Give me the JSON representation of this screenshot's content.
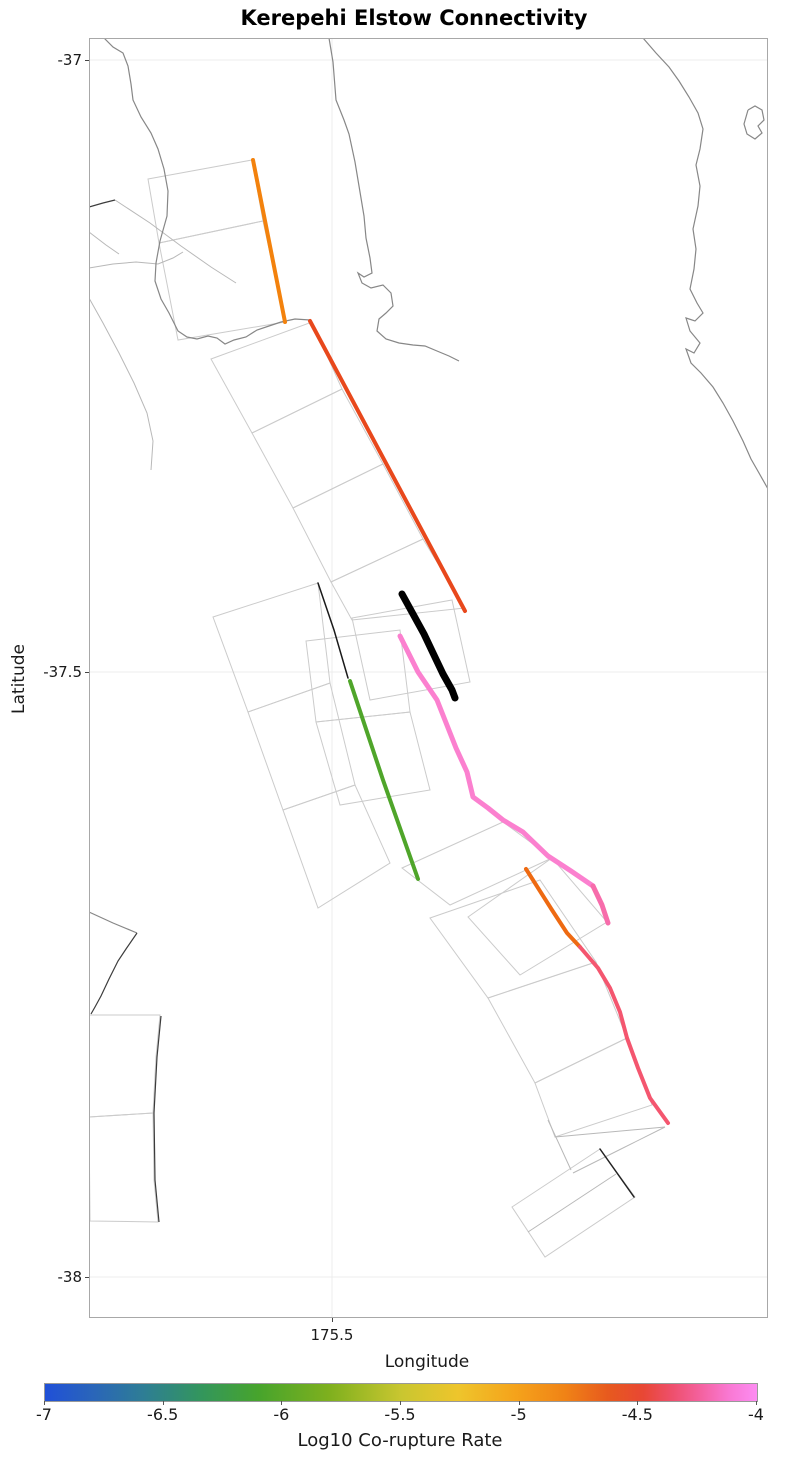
{
  "title": "Kerepehi Elstow Connectivity",
  "axes": {
    "x_label": "Longitude",
    "y_label": "Latitude",
    "x_ticks": [
      "175.5"
    ],
    "y_ticks": [
      "-37",
      "-37.5",
      "-38"
    ]
  },
  "colorbar": {
    "label": "Log10 Co-rupture Rate",
    "ticks": [
      "-7",
      "-6.5",
      "-6",
      "-5.5",
      "-5",
      "-4.5",
      "-4"
    ],
    "min": -7,
    "max": -4,
    "gradient": [
      [
        0,
        "#2050d8"
      ],
      [
        7,
        "#2a66b8"
      ],
      [
        14,
        "#2e7e94"
      ],
      [
        22,
        "#33965c"
      ],
      [
        30,
        "#47a42c"
      ],
      [
        40,
        "#7fb01e"
      ],
      [
        50,
        "#c9c630"
      ],
      [
        58,
        "#eec52c"
      ],
      [
        66,
        "#f5a31b"
      ],
      [
        73,
        "#f08316"
      ],
      [
        79,
        "#e75a1e"
      ],
      [
        84,
        "#e84734"
      ],
      [
        88,
        "#ee4f6b"
      ],
      [
        92,
        "#f4619e"
      ],
      [
        96,
        "#f978d2"
      ],
      [
        100,
        "#fc8cf2"
      ]
    ]
  },
  "chart_data": {
    "type": "map",
    "title": "Kerepehi Elstow Connectivity",
    "xlabel": "Longitude",
    "ylabel": "Latitude",
    "x_ticks": [
      175.5
    ],
    "y_ticks": [
      -37,
      -37.5,
      -38
    ],
    "xlim_approx": [
      175.25,
      175.95
    ],
    "ylim_approx": [
      -38.03,
      -36.98
    ],
    "grid": true,
    "legend_position": "bottom",
    "colorbar": {
      "label": "Log10 Co-rupture Rate",
      "range": [
        -7,
        -4
      ],
      "ticks": [
        -7,
        -6.5,
        -6,
        -5.5,
        -5,
        -4.5,
        -4
      ],
      "orientation": "horizontal"
    },
    "fault_traces": [
      {
        "id": "north-orange",
        "color": "#f3820d",
        "approx_log10_corupture_rate": -4.9
      },
      {
        "id": "central-red-orange",
        "color": "#e8481c",
        "approx_log10_corupture_rate": -4.6
      },
      {
        "id": "thick-black-target",
        "color": "#000000",
        "approx_log10_corupture_rate": null,
        "note": "target section, not on colorbar"
      },
      {
        "id": "thin-black",
        "color": "#1a1a1a",
        "approx_log10_corupture_rate": null
      },
      {
        "id": "central-green",
        "color": "#4fa52a",
        "approx_log10_corupture_rate": -6.0
      },
      {
        "id": "pink",
        "color": "#fb80cf",
        "approx_log10_corupture_rate": -4.2
      },
      {
        "id": "pink-tail",
        "color": "#f76cab",
        "approx_log10_corupture_rate": -4.3
      },
      {
        "id": "south-orange",
        "color": "#ee6a12",
        "approx_log10_corupture_rate": -4.8
      },
      {
        "id": "south-pink-red",
        "color": "#f4566f",
        "approx_log10_corupture_rate": -4.4
      },
      {
        "id": "bottom-black",
        "color": "#222222",
        "approx_log10_corupture_rate": null
      }
    ],
    "features": [
      "firth-of-thames-coastline",
      "coromandel-coastline",
      "offshore-island",
      "fault-surface-projection-patches"
    ]
  },
  "map": {
    "style": {
      "grid": "#ececec",
      "patch": "#cbcbcb",
      "faint": "#b8b8b8",
      "coast": "#878787",
      "dark": "#3c3c3c",
      "border": "#a8a8a8"
    },
    "gridlines": {
      "x": [
        332
      ],
      "y": [
        60,
        672,
        1277
      ]
    },
    "patches": [
      [
        [
          148,
          179
        ],
        [
          252,
          160
        ],
        [
          263,
          221
        ],
        [
          159,
          243
        ]
      ],
      [
        [
          159,
          243
        ],
        [
          263,
          221
        ],
        [
          285,
          322
        ],
        [
          178,
          340
        ]
      ],
      [
        [
          211,
          359
        ],
        [
          312,
          322
        ],
        [
          342,
          389
        ],
        [
          252,
          433
        ]
      ],
      [
        [
          252,
          433
        ],
        [
          342,
          389
        ],
        [
          383,
          464
        ],
        [
          293,
          508
        ]
      ],
      [
        [
          293,
          508
        ],
        [
          383,
          464
        ],
        [
          423,
          539
        ],
        [
          331,
          582
        ]
      ],
      [
        [
          331,
          582
        ],
        [
          423,
          539
        ],
        [
          465,
          608
        ],
        [
          352,
          620
        ]
      ],
      [
        [
          213,
          617
        ],
        [
          318,
          583
        ],
        [
          330,
          683
        ],
        [
          248,
          712
        ]
      ],
      [
        [
          248,
          712
        ],
        [
          330,
          683
        ],
        [
          355,
          785
        ],
        [
          283,
          810
        ]
      ],
      [
        [
          283,
          810
        ],
        [
          355,
          785
        ],
        [
          390,
          863
        ],
        [
          318,
          908
        ]
      ],
      [
        [
          306,
          641
        ],
        [
          400,
          630
        ],
        [
          410,
          712
        ],
        [
          316,
          722
        ]
      ],
      [
        [
          352,
          618
        ],
        [
          452,
          600
        ],
        [
          470,
          682
        ],
        [
          370,
          700
        ]
      ],
      [
        [
          316,
          722
        ],
        [
          410,
          712
        ],
        [
          430,
          790
        ],
        [
          340,
          805
        ]
      ],
      [
        [
          402,
          868
        ],
        [
          503,
          822
        ],
        [
          552,
          858
        ],
        [
          450,
          905
        ]
      ],
      [
        [
          468,
          917
        ],
        [
          552,
          858
        ],
        [
          607,
          922
        ],
        [
          520,
          975
        ]
      ],
      [
        [
          430,
          918
        ],
        [
          540,
          880
        ],
        [
          596,
          962
        ],
        [
          488,
          998
        ]
      ],
      [
        [
          488,
          998
        ],
        [
          596,
          962
        ],
        [
          627,
          1038
        ],
        [
          535,
          1083
        ]
      ],
      [
        [
          535,
          1083
        ],
        [
          627,
          1038
        ],
        [
          652,
          1105
        ],
        [
          555,
          1137
        ]
      ],
      [
        [
          512,
          1207
        ],
        [
          600,
          1149
        ],
        [
          635,
          1197
        ],
        [
          545,
          1257
        ]
      ],
      [
        [
          89,
          1015
        ],
        [
          160,
          1015
        ],
        [
          156,
          1057
        ],
        [
          153,
          1113
        ],
        [
          89,
          1117
        ]
      ],
      [
        [
          89,
          1117
        ],
        [
          153,
          1113
        ],
        [
          154,
          1180
        ],
        [
          158,
          1222
        ],
        [
          90,
          1221
        ]
      ]
    ],
    "faint_lines": [
      [
        [
          115,
          200
        ],
        [
          150,
          223
        ],
        [
          181,
          246
        ],
        [
          211,
          267
        ],
        [
          236,
          283
        ]
      ],
      [
        [
          89,
          268
        ],
        [
          113,
          264
        ],
        [
          136,
          262
        ],
        [
          158,
          264
        ],
        [
          173,
          258
        ],
        [
          183,
          252
        ]
      ],
      [
        [
          89,
          298
        ],
        [
          103,
          323
        ],
        [
          119,
          353
        ],
        [
          134,
          383
        ],
        [
          147,
          413
        ],
        [
          153,
          441
        ],
        [
          151,
          470
        ]
      ],
      [
        [
          89,
          232
        ],
        [
          106,
          245
        ],
        [
          119,
          254
        ]
      ],
      [
        [
          665,
          1127
        ],
        [
          619,
          1150
        ],
        [
          573,
          1173
        ]
      ],
      [
        [
          548,
          1120
        ],
        [
          560,
          1146
        ],
        [
          571,
          1170
        ]
      ],
      [
        [
          528,
          1232
        ],
        [
          616,
          1174
        ]
      ],
      [
        [
          555,
          1137
        ],
        [
          665,
          1127
        ]
      ]
    ],
    "coastlines": [
      [
        [
          104,
          38
        ],
        [
          113,
          47
        ],
        [
          123,
          53
        ],
        [
          128,
          66
        ],
        [
          131,
          84
        ],
        [
          133,
          100
        ],
        [
          141,
          117
        ],
        [
          151,
          133
        ],
        [
          158,
          149
        ],
        [
          164,
          169
        ],
        [
          168,
          191
        ],
        [
          167,
          216
        ],
        [
          160,
          241
        ],
        [
          156,
          263
        ],
        [
          155,
          281
        ],
        [
          161,
          299
        ],
        [
          169,
          313
        ],
        [
          178,
          331
        ],
        [
          187,
          337
        ],
        [
          197,
          339
        ],
        [
          208,
          336
        ],
        [
          217,
          338
        ],
        [
          225,
          344
        ],
        [
          234,
          340
        ],
        [
          246,
          337
        ],
        [
          257,
          330
        ],
        [
          269,
          326
        ],
        [
          281,
          322
        ],
        [
          295,
          319
        ],
        [
          310,
          320
        ]
      ],
      [
        [
          329,
          38
        ],
        [
          333,
          62
        ],
        [
          336,
          100
        ],
        [
          344,
          120
        ],
        [
          349,
          134
        ],
        [
          355,
          162
        ],
        [
          360,
          192
        ],
        [
          364,
          216
        ],
        [
          366,
          238
        ],
        [
          370,
          258
        ],
        [
          372,
          273
        ],
        [
          364,
          277
        ],
        [
          358,
          273
        ],
        [
          362,
          283
        ],
        [
          371,
          288
        ],
        [
          383,
          285
        ],
        [
          391,
          293
        ],
        [
          393,
          306
        ],
        [
          386,
          313
        ],
        [
          379,
          319
        ],
        [
          377,
          331
        ],
        [
          386,
          339
        ],
        [
          399,
          343
        ],
        [
          413,
          345
        ],
        [
          425,
          346
        ],
        [
          437,
          351
        ],
        [
          449,
          356
        ],
        [
          459,
          361
        ]
      ],
      [
        [
          643,
          38
        ],
        [
          656,
          53
        ],
        [
          669,
          67
        ],
        [
          679,
          81
        ],
        [
          689,
          97
        ],
        [
          698,
          113
        ],
        [
          703,
          129
        ],
        [
          700,
          149
        ],
        [
          696,
          165
        ],
        [
          700,
          186
        ],
        [
          698,
          206
        ],
        [
          693,
          229
        ],
        [
          696,
          249
        ],
        [
          694,
          269
        ],
        [
          690,
          289
        ],
        [
          697,
          303
        ],
        [
          703,
          313
        ],
        [
          695,
          321
        ],
        [
          686,
          318
        ],
        [
          690,
          331
        ],
        [
          700,
          343
        ],
        [
          694,
          353
        ],
        [
          686,
          349
        ],
        [
          691,
          363
        ],
        [
          701,
          373
        ],
        [
          713,
          387
        ],
        [
          723,
          403
        ],
        [
          733,
          421
        ],
        [
          743,
          441
        ],
        [
          751,
          459
        ],
        [
          759,
          473
        ],
        [
          768,
          489
        ]
      ],
      [
        [
          748,
          110
        ],
        [
          755,
          106
        ],
        [
          762,
          110
        ],
        [
          764,
          120
        ],
        [
          758,
          126
        ],
        [
          762,
          133
        ],
        [
          755,
          139
        ],
        [
          747,
          134
        ],
        [
          744,
          124
        ],
        [
          748,
          110
        ]
      ],
      [
        [
          89,
          912
        ],
        [
          113,
          923
        ],
        [
          137,
          933
        ]
      ]
    ],
    "dark_lines": [
      [
        [
          89,
          207
        ],
        [
          103,
          203
        ],
        [
          115,
          200
        ]
      ],
      [
        [
          137,
          933
        ],
        [
          126,
          949
        ],
        [
          118,
          961
        ],
        [
          109,
          979
        ],
        [
          101,
          996
        ],
        [
          95,
          1007
        ],
        [
          91,
          1014
        ]
      ],
      [
        [
          161,
          1016
        ],
        [
          157,
          1057
        ],
        [
          154,
          1113
        ],
        [
          155,
          1180
        ],
        [
          159,
          1222
        ]
      ]
    ],
    "traces": [
      {
        "id": "thin-black",
        "color": "#1a1a1a",
        "width": 1.5,
        "points": [
          [
            318,
            583
          ],
          [
            334,
            630
          ],
          [
            348,
            678
          ]
        ]
      },
      {
        "id": "north-orange",
        "color": "#f3820d",
        "width": 4,
        "points": [
          [
            253,
            160
          ],
          [
            285,
            322
          ]
        ]
      },
      {
        "id": "central-red-orange",
        "color": "#e8481c",
        "width": 4,
        "points": [
          [
            310,
            321
          ],
          [
            465,
            611
          ]
        ]
      },
      {
        "id": "central-green",
        "color": "#4fa52a",
        "width": 4,
        "points": [
          [
            350,
            681
          ],
          [
            383,
            780
          ],
          [
            418,
            879
          ]
        ]
      },
      {
        "id": "pink",
        "color": "#fb80cf",
        "width": 5,
        "points": [
          [
            400,
            636
          ],
          [
            418,
            672
          ],
          [
            437,
            700
          ],
          [
            456,
            748
          ],
          [
            467,
            772
          ],
          [
            473,
            797
          ],
          [
            488,
            808
          ],
          [
            503,
            820
          ],
          [
            523,
            832
          ],
          [
            548,
            856
          ],
          [
            571,
            871
          ],
          [
            593,
            886
          ]
        ]
      },
      {
        "id": "pink-tail",
        "color": "#f76cab",
        "width": 5,
        "points": [
          [
            593,
            886
          ],
          [
            602,
            905
          ],
          [
            608,
            923
          ]
        ]
      },
      {
        "id": "south-orange",
        "color": "#ee6a12",
        "width": 4,
        "points": [
          [
            526,
            869
          ],
          [
            552,
            910
          ],
          [
            567,
            933
          ],
          [
            580,
            947
          ]
        ]
      },
      {
        "id": "south-pink-red",
        "color": "#f4566f",
        "width": 4,
        "points": [
          [
            580,
            947
          ],
          [
            598,
            968
          ],
          [
            610,
            988
          ],
          [
            620,
            1012
          ],
          [
            627,
            1038
          ],
          [
            638,
            1068
          ],
          [
            650,
            1098
          ],
          [
            668,
            1123
          ]
        ]
      },
      {
        "id": "thick-black-target",
        "color": "#000000",
        "width": 7,
        "points": [
          [
            402,
            594
          ],
          [
            413,
            614
          ],
          [
            424,
            634
          ],
          [
            433,
            653
          ],
          [
            443,
            674
          ],
          [
            452,
            690
          ],
          [
            455,
            698
          ]
        ]
      },
      {
        "id": "bottom-black",
        "color": "#222222",
        "width": 1.5,
        "points": [
          [
            600,
            1149
          ],
          [
            634,
            1197
          ]
        ]
      }
    ]
  }
}
